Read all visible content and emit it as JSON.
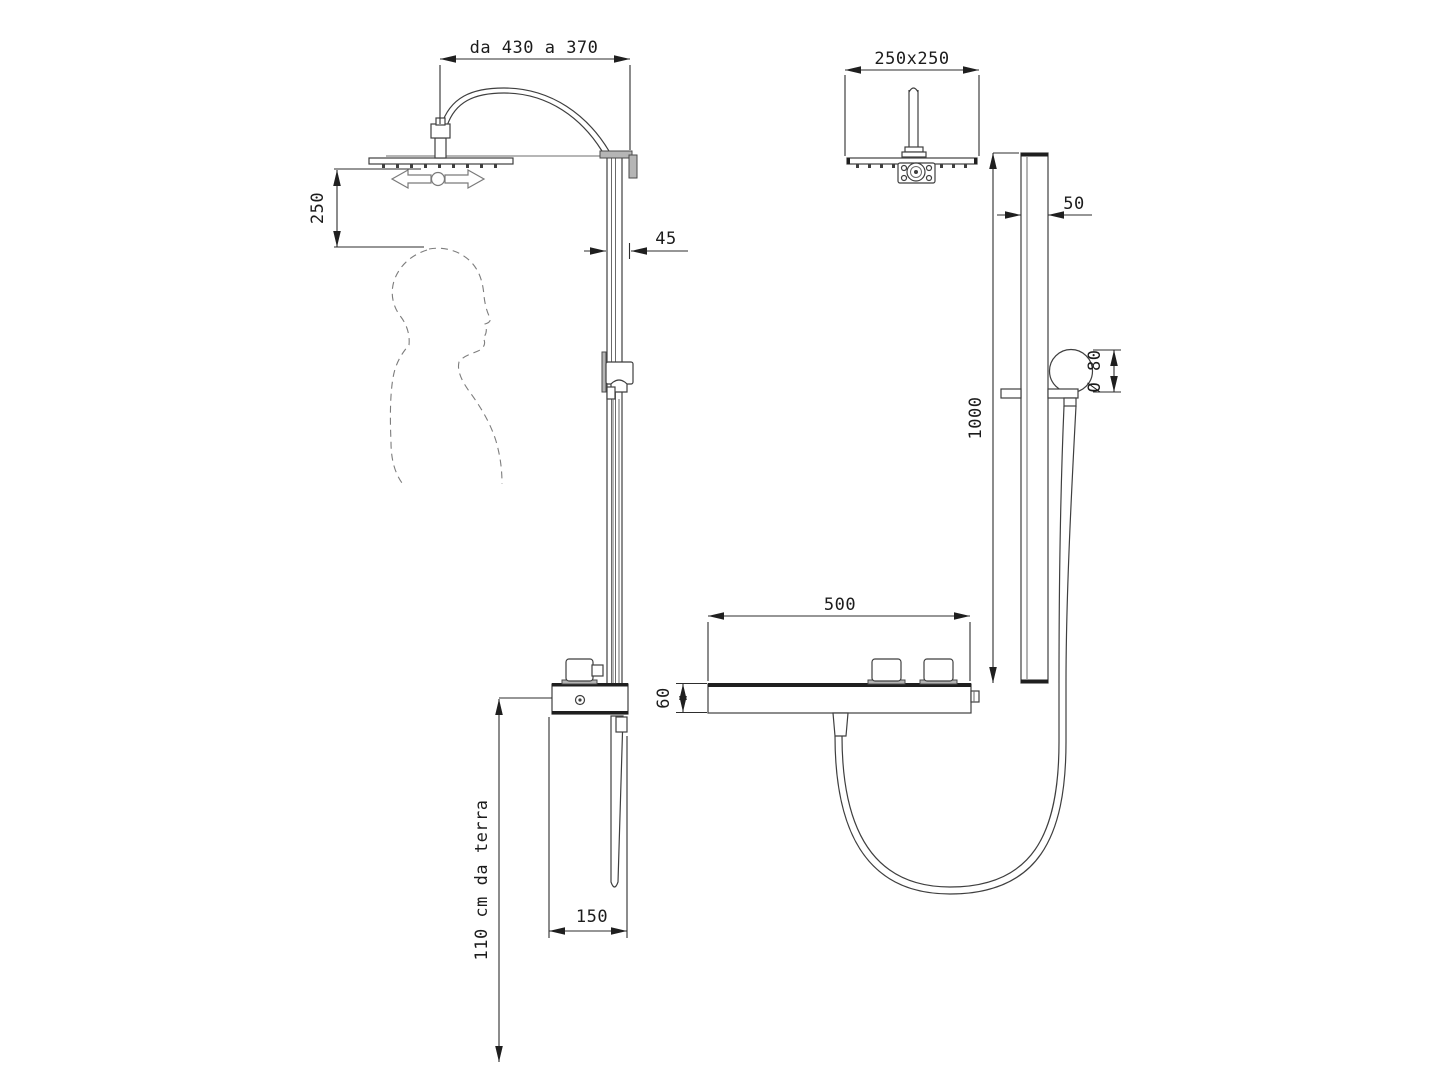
{
  "document_type": "shower-column-dimension-drawing",
  "side_view": {
    "dims": {
      "arm_reach": "da 430 a 370",
      "head_clearance": "250",
      "column_depth": "45",
      "valve_body_width": "150",
      "mounting_height": "110 cm da terra"
    }
  },
  "front_view": {
    "dims": {
      "head_size": "250x250",
      "rail_width": "50",
      "rail_height": "1000",
      "handshower_diameter": "Ø 80",
      "shelf_width": "500",
      "shelf_thickness": "60"
    }
  },
  "icons": {
    "swivel_arrows": "left-right-swivel-arrows-icon",
    "user_silhouette": "dashed-person-profile"
  },
  "colors": {
    "background": "#ffffff",
    "main_line": "#3f3f3f",
    "dimension_line": "#2e2e2e",
    "gray_detail": "#9d9d9d",
    "dark_fill": "#1f1f1f",
    "silhouette_dash": "#7d7d7d",
    "text": "#1c1c1c"
  }
}
